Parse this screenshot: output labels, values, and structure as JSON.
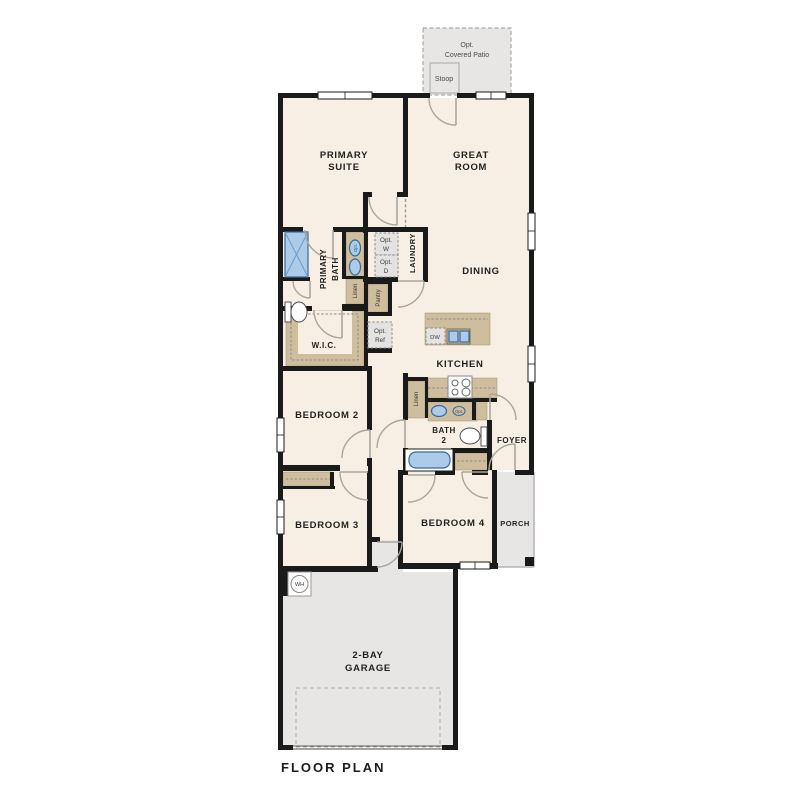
{
  "plan": {
    "title": "FLOOR PLAN"
  },
  "rooms": {
    "primary_suite": [
      "PRIMARY",
      "SUITE"
    ],
    "great_room": [
      "GREAT",
      "ROOM"
    ],
    "primary_bath": [
      "PRIMARY",
      "BATH"
    ],
    "laundry": "LAUNDRY",
    "dining": "DINING",
    "wic": "W.I.C.",
    "kitchen": "KITCHEN",
    "bedroom2": "BEDROOM 2",
    "bath2": [
      "BATH",
      "2"
    ],
    "foyer": "FOYER",
    "bedroom3": "BEDROOM 3",
    "bedroom4": "BEDROOM 4",
    "porch": "PORCH",
    "garage": [
      "2-BAY",
      "GARAGE"
    ]
  },
  "outdoor": {
    "covered_patio": [
      "Opt.",
      "Covered Patio"
    ],
    "stoop": "Stoop"
  },
  "closets": {
    "linen_primary": "Linen",
    "pantry": "Pantry",
    "linen_hall": "Linen"
  },
  "fixtures": {
    "water_heater": "WH",
    "dishwasher": "DW",
    "optional_washer": [
      "Opt.",
      "W"
    ],
    "optional_dryer": [
      "Opt.",
      "D"
    ],
    "optional_fridge": [
      "Opt.",
      "Ref"
    ],
    "optional_sink_primary": "Opt.",
    "optional_sink_bath2": "Opt."
  },
  "colors": {
    "wall": "#1a1a1a",
    "floor": "#f7efe3",
    "outdoor_concrete": "#e7e6e4",
    "cabinetry": "#cfbe9d",
    "fixture_blue": "#abcbe9",
    "fixture_blue_stroke": "#35689c",
    "optional_dash_fill": "#e4e3e1",
    "door_swing": "#aaa69e",
    "text": "#1f1f1f"
  }
}
